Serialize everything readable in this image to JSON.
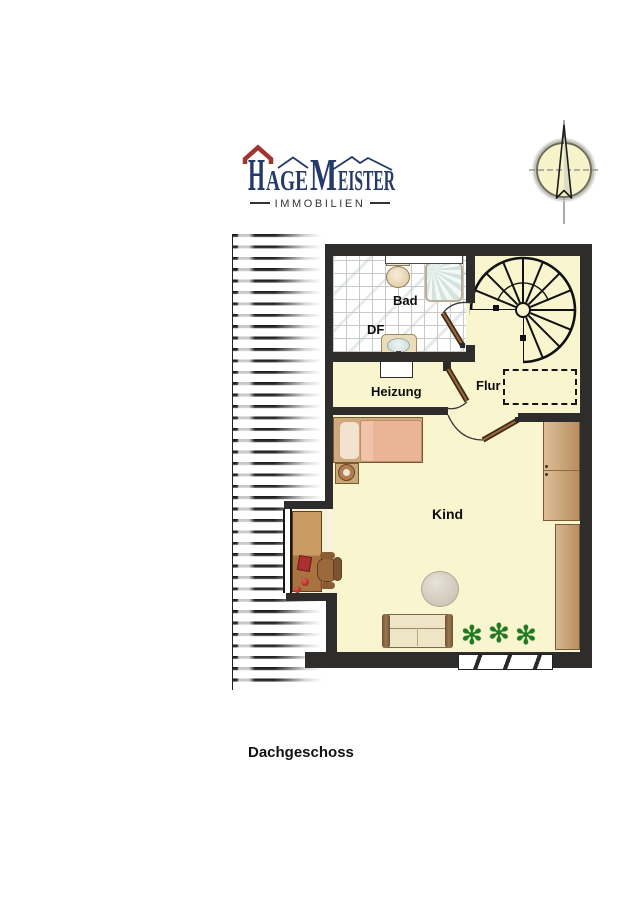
{
  "header": {
    "logo": {
      "h": "H",
      "age": "AGE",
      "m": "M",
      "eister": "EISTER",
      "subtitle": "IMMOBILIEN"
    }
  },
  "plan": {
    "rooms": {
      "bad": "Bad",
      "df": "DF",
      "heizung": "Heizung",
      "flur": "Flur",
      "kind": "Kind"
    }
  },
  "caption": "Dachgeschoss",
  "icons": {
    "plant_glyph": "✻",
    "compass": "compass-north-icon"
  },
  "colors": {
    "logo_blue": "#25396b",
    "logo_red": "#a03430",
    "wall": "#2e2d2b",
    "floor": "#f8f5cf",
    "wood": "#c49a6c",
    "plant_green": "#1e7a1e",
    "compass_face": "#f6f2ca"
  }
}
